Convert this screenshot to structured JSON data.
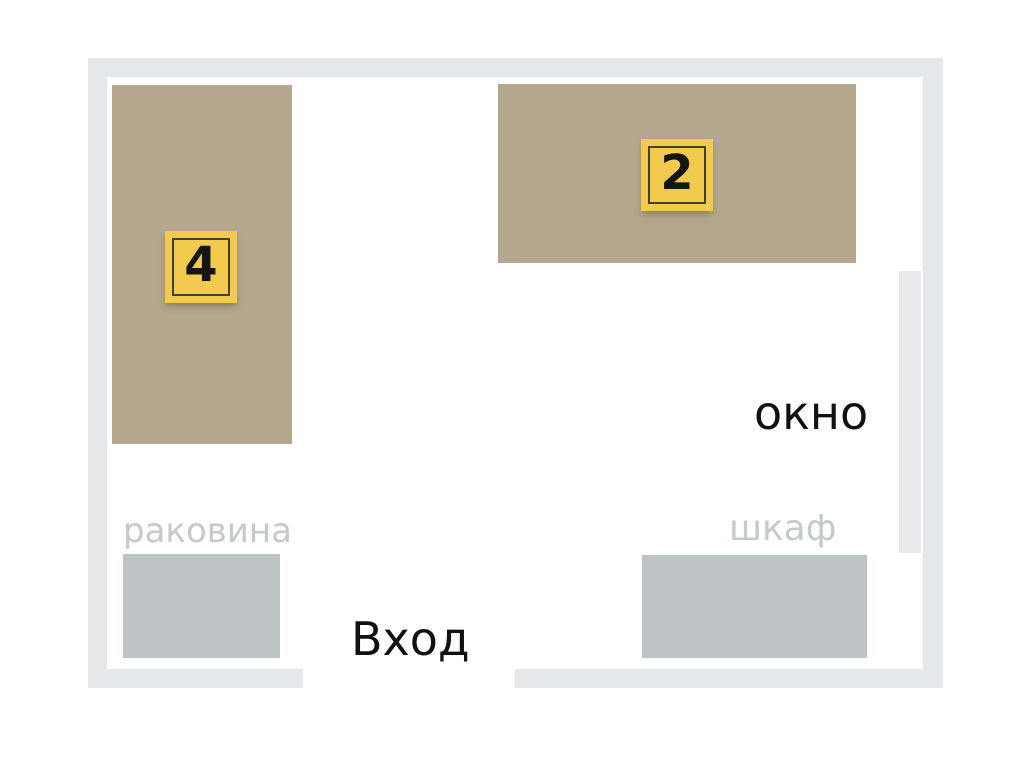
{
  "plan": {
    "name": "room-floor-plan",
    "labels": {
      "sink": "раковина",
      "cabinet": "шкаф",
      "window": "окно",
      "entrance": "Вход"
    },
    "markers": [
      {
        "number": "4",
        "location": "left-desk"
      },
      {
        "number": "2",
        "location": "top-desk"
      }
    ]
  },
  "colors": {
    "wall": "#e4e8ea",
    "window": "#e9eced",
    "desk": "#b5a68e",
    "fixture": "#bec3c6",
    "marker_bg": "#f2cb4e",
    "marker_outline": "#45401f",
    "label_muted": "#c4c9cb",
    "label_dark": "#111111"
  }
}
